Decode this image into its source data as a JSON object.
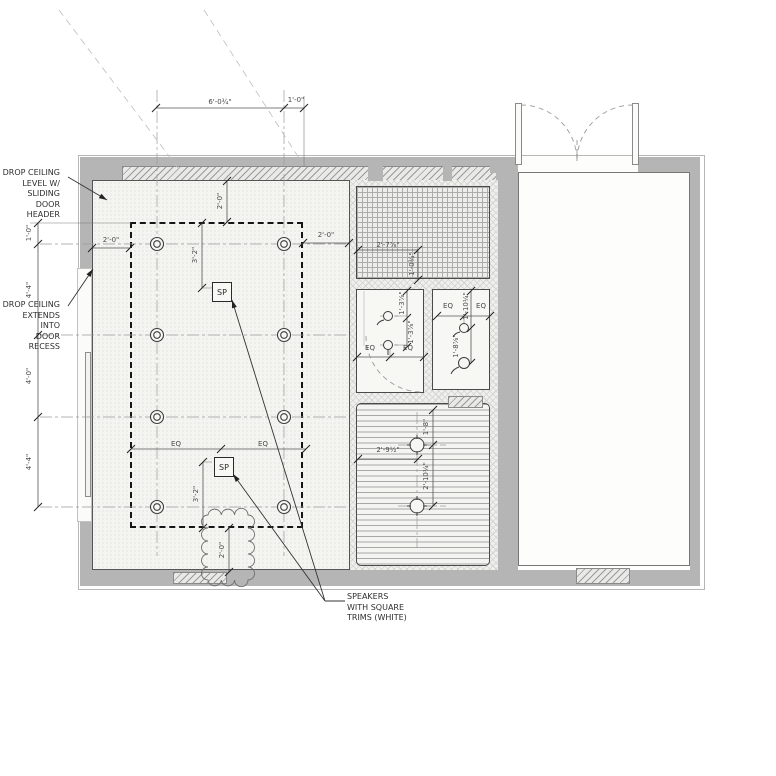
{
  "drawing": {
    "notes": {
      "drop_ceiling_header": "DROP CEILING\nLEVEL W/\nSLIDING DOOR\nHEADER",
      "drop_ceiling_recess": "DROP CEILING\nEXTENDS INTO\nDOOR RECESS",
      "speakers": "SPEAKERS\nWITH SQUARE\nTRIMS (WHITE)"
    },
    "tags": {
      "speaker": "SP"
    },
    "dims": {
      "top_w1": "6'-0¾\"",
      "top_w2": "1'-0\"",
      "left_1": "1'-0\"",
      "left_2": "4'-4\"",
      "left_3": "4'-0\"",
      "left_4": "4'-4\"",
      "main_top_offset": "2'-0\"",
      "main_left_offset": "2'-0\"",
      "main_right_offset": "2'-0\"",
      "main_sp_top": "3'-2\"",
      "main_sp_bottom": "3'-2\"",
      "main_bottom_cloud": "2'-0\"",
      "eq": "EQ",
      "grid_room_w": "2'-7⅞\"",
      "grid_room_h": "1'-0¾\"",
      "bath_left_a": "1'-3⅞\"",
      "bath_left_b": "1'-3⅞\"",
      "bath_right_a": "1'-10¼\"",
      "bath_right_b": "1'-8⅞\"",
      "slat_top": "1'-8\"",
      "slat_mid": "2'-10¼\"",
      "slat_left": "2'-9½\""
    },
    "colors": {
      "wall": "#b5b5b5",
      "line": "#444444",
      "dim_text": "#4a4a4a"
    }
  }
}
